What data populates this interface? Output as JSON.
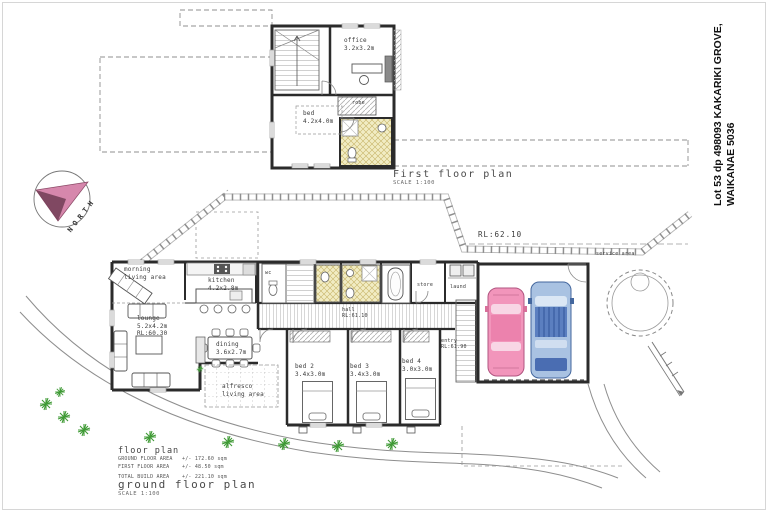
{
  "sheet": {
    "address_line1": "Lot 53 dp 498093 KAKARIKI GROVE,",
    "address_line2": "WAIKANAE 5036"
  },
  "north": {
    "label": "NORTH"
  },
  "first_floor": {
    "title": "First floor plan",
    "scale": "SCALE 1:100",
    "rooms": {
      "office": "office\n3.2x3.2m",
      "robe": "robe",
      "bed": "bed\n4.2x4.0m"
    }
  },
  "site": {
    "road_level": "RL:62.10",
    "service_area": "service area"
  },
  "ground_floor": {
    "title": "ground floor plan",
    "scale": "SCALE 1:100",
    "rooms": {
      "morning": "morning\nliving area",
      "kitchen": "kitchen\n4.2x2.8m",
      "lounge": "lounge\n5.2x4.2m\nRL:60.30",
      "dining": "dining\n3.6x2.7m",
      "alfresco": "alfresco\nliving area",
      "hall": "hall\nRL:61.10",
      "wc": "wc",
      "store": "store",
      "laund": "laund",
      "entry": "entry\nRL:61.90",
      "bed2": "bed 2\n3.4x3.0m",
      "bed3": "bed 3\n3.4x3.0m",
      "bed4": "bed 4\n3.0x3.0m"
    }
  },
  "schedule": {
    "title": "floor plan",
    "rows": [
      {
        "label": "GROUND FLOOR AREA",
        "value": "+/- 172.60 sqm"
      },
      {
        "label": "FIRST FLOOR AREA",
        "value": "+/- 48.50 sqm"
      },
      {
        "label": "TOTAL BUILD AREA",
        "value": "+/- 221.10 sqm"
      }
    ]
  },
  "colors": {
    "car_pink": "#f295bb",
    "car_pink_roof": "#ec82ad",
    "car_blue": "#a9c2e2",
    "car_blue_dark": "#5b7fc0",
    "tile_yellow": "#f1ecc3",
    "plant_green": "#3f9a35",
    "north_pink": "#d687ac",
    "north_dark": "#713d55",
    "wall": "#2b2b2b",
    "fence_gray": "#8f8f8f"
  }
}
